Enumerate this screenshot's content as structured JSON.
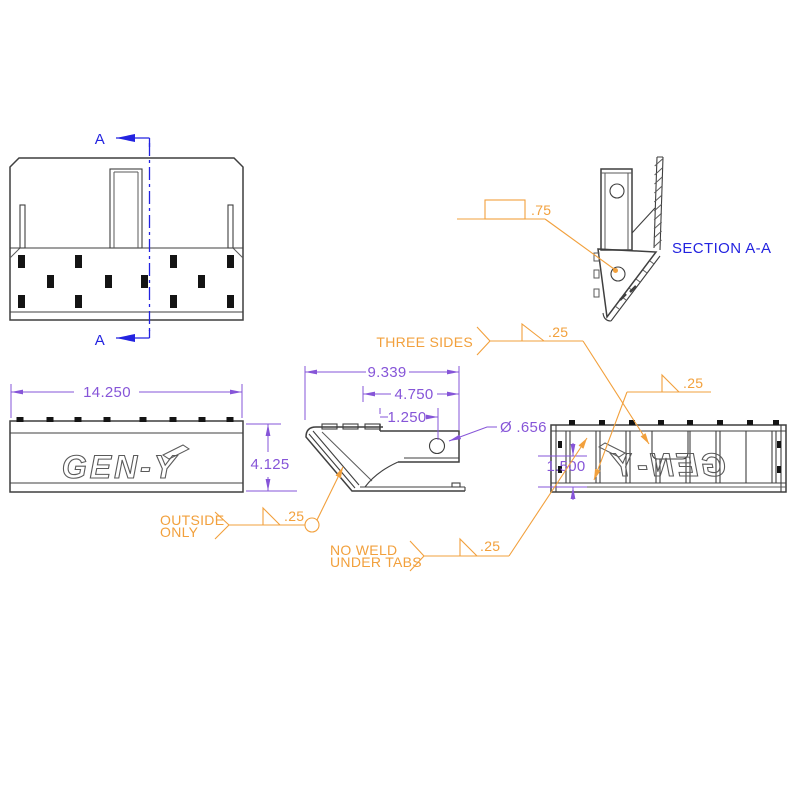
{
  "drawing": {
    "logo": "GEN-Y",
    "colors": {
      "edge": "#3f3f3f",
      "dimension": "#8655d8",
      "weld_note": "#f2a03c",
      "section": "#2323e0"
    },
    "section_view": {
      "marker": "A",
      "label": "SECTION A-A"
    },
    "dimensions": {
      "overall_width": "14.250",
      "overall_height": "4.125",
      "profile_length": "9.339",
      "arm_length": "4.750",
      "hole_offset": "1.250",
      "hole_diameter": "Ø .656",
      "step_height": "1.500"
    },
    "weld_notes": {
      "plug_weld_size": ".75",
      "three_sides": {
        "note": "THREE SIDES",
        "size": ".25"
      },
      "center_plate": {
        "size": ".25"
      },
      "outside_only": {
        "note_line1": "OUTSIDE",
        "note_line2": "ONLY",
        "size": ".25"
      },
      "no_weld_under_tabs": {
        "note_line1": "NO WELD",
        "note_line2": "UNDER TABS",
        "size": ".25"
      }
    }
  }
}
